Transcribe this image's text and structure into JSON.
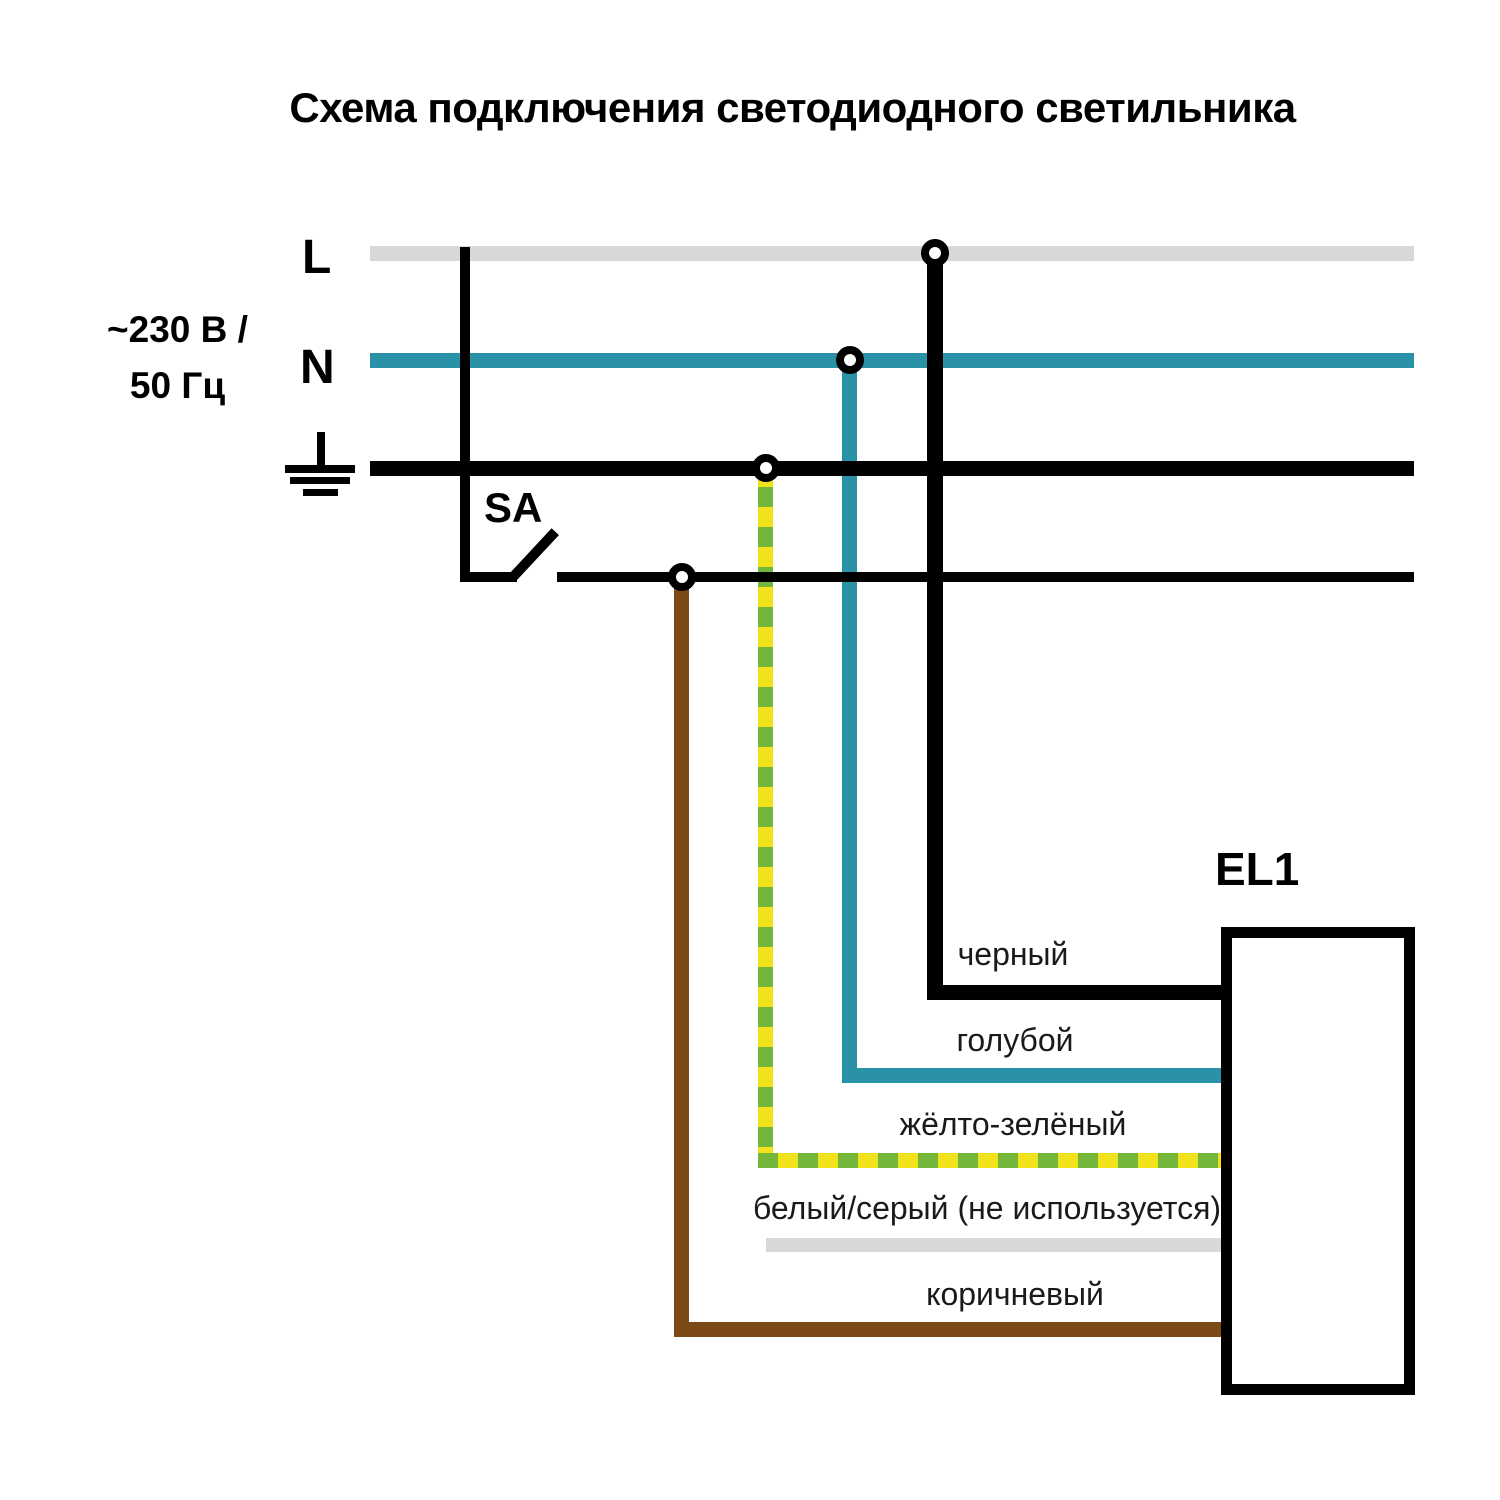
{
  "title": "Схема подключения светодиодного светильника",
  "power_source": {
    "line_label": "L",
    "neutral_label": "N",
    "voltage_line1": "~230 В /",
    "voltage_line2": "50 Гц"
  },
  "switch_label": "SA",
  "luminaire_label": "EL1",
  "wire_labels": {
    "black": "черный",
    "blue": "голубой",
    "yellow_green": "жёлто-зелёный",
    "white_gray": "белый/серый (не используется)",
    "brown": "коричневый"
  },
  "colors": {
    "line_gray": "#d8d8d8",
    "neutral_teal": "#2992a7",
    "earth_black": "#000000",
    "brown": "#7b4a17",
    "yellow": "#f2e21c",
    "green": "#72b73c",
    "label_text": "#1a1a1a"
  }
}
